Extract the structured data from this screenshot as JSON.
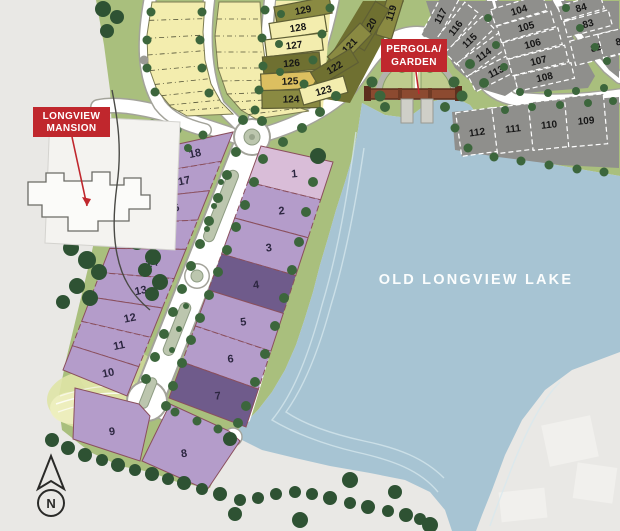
{
  "map_title": "residential lakefront site plan",
  "lake": {
    "label": "OLD LONGVIEW LAKE"
  },
  "landmarks": {
    "mansion": {
      "line1": "LONGVIEW",
      "line2": "MANSION"
    },
    "pergola": {
      "line1": "PERGOLA/",
      "line2": "GARDEN"
    }
  },
  "compass": {
    "label": "N"
  },
  "colors": {
    "bg": "#e9e8e5",
    "grass": "#a9bf7d",
    "parkYellow": "#dfe4a6",
    "lake": "#a7c4d3",
    "lakeLine": "#d7e8ee",
    "road": "#ffffff",
    "roadEdge": "#a3a39a",
    "median": "#bcc6ae",
    "tree": "#3c663c",
    "treeDark": "#2e5233",
    "lotPurple": "#b49cca",
    "lotPurpleDark": "#6f5b8b",
    "lotPink": "#d9bdd8",
    "lotGray": "#8f8f8c",
    "yellowPale": "#f3edae",
    "gold": "#dcbf60",
    "olive": "#8a8a42",
    "oliveDark": "#6f7031",
    "red": "#c0272d"
  },
  "lots": {
    "purple_left": [
      "18",
      "17",
      "16",
      "15",
      "14",
      "13",
      "12",
      "11",
      "10"
    ],
    "purple_right": [
      "1",
      "2",
      "3",
      "4",
      "5",
      "6",
      "7"
    ],
    "purple_south": [
      "9",
      "8"
    ],
    "yellow_column": [
      "129",
      "128",
      "127",
      "126",
      "125",
      "124"
    ],
    "yellow_fan": [
      "119",
      "120",
      "121",
      "122",
      "123"
    ],
    "gray_fan": [
      "117",
      "116",
      "115",
      "114",
      "113"
    ],
    "gray_column": [
      "104",
      "105",
      "106",
      "107",
      "108"
    ],
    "gray_east": [
      "84",
      "83",
      "82",
      "81"
    ],
    "gray_row": [
      "112",
      "111",
      "110",
      "109"
    ]
  }
}
